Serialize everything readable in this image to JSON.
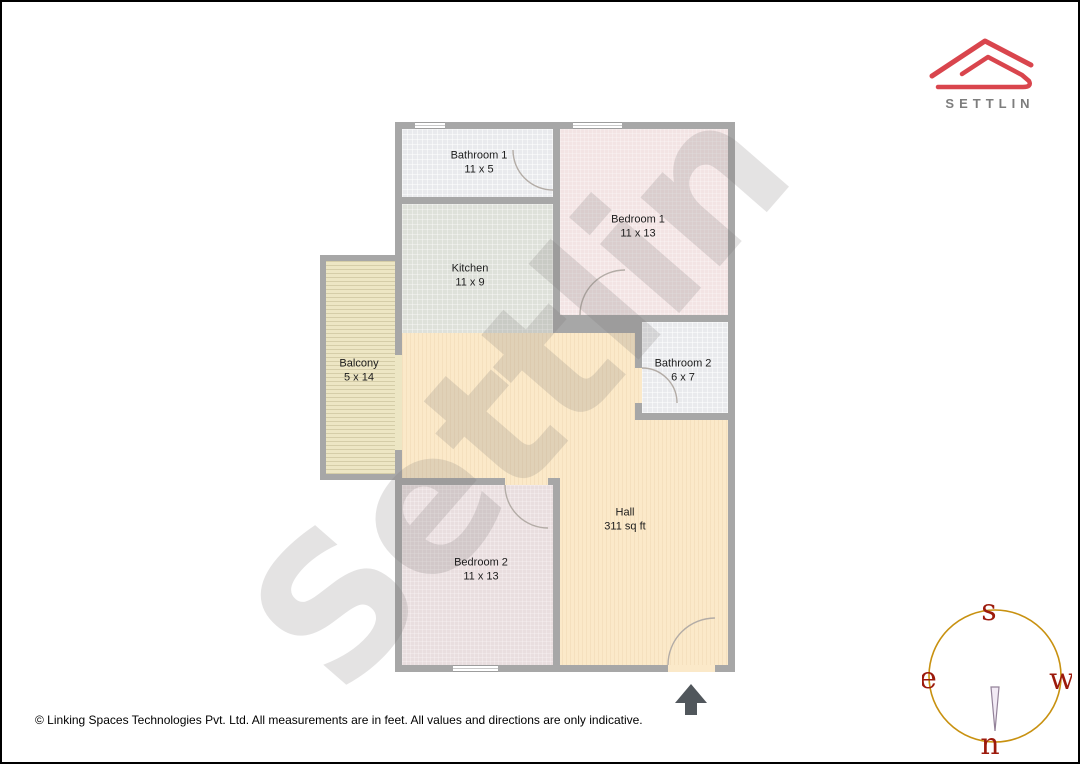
{
  "brand": {
    "name": "SETTLIN"
  },
  "floorplan": {
    "watermark": "Settlin",
    "rooms": [
      {
        "name": "Bathroom 1",
        "dims": "11 x 5"
      },
      {
        "name": "Bedroom 1",
        "dims": "11 x 13"
      },
      {
        "name": "Kitchen",
        "dims": "11 x 9"
      },
      {
        "name": "Balcony",
        "dims": "5 x 14"
      },
      {
        "name": "Bathroom 2",
        "dims": "6 x 7"
      },
      {
        "name": "Hall",
        "dims": "311 sq ft"
      },
      {
        "name": "Bedroom 2",
        "dims": "11 x 13"
      }
    ]
  },
  "compass": {
    "top": "s",
    "left": "e",
    "right": "w",
    "bottom": "n"
  },
  "footer": {
    "disclaimer": "© Linking Spaces Technologies Pvt. Ltd. All measurements are in feet. All values and directions are only indicative."
  },
  "colors": {
    "brand_red": "#d9454d",
    "brand_text_gray": "#7d7d7d",
    "wall_gray": "#a7a7a7",
    "bathroom_fill": "#e9eaed",
    "kitchen_fill": "#dee1da",
    "bedroom1_fill": "#f3e4e4",
    "bedroom2_fill": "#e9dedf",
    "hall_fill": "#fbe9c9",
    "balcony_fill": "#ede6c4",
    "compass_ring_gold": "#c89110",
    "compass_letters_red": "#9c1a0c",
    "north_arrow_gray": "#51575c"
  }
}
